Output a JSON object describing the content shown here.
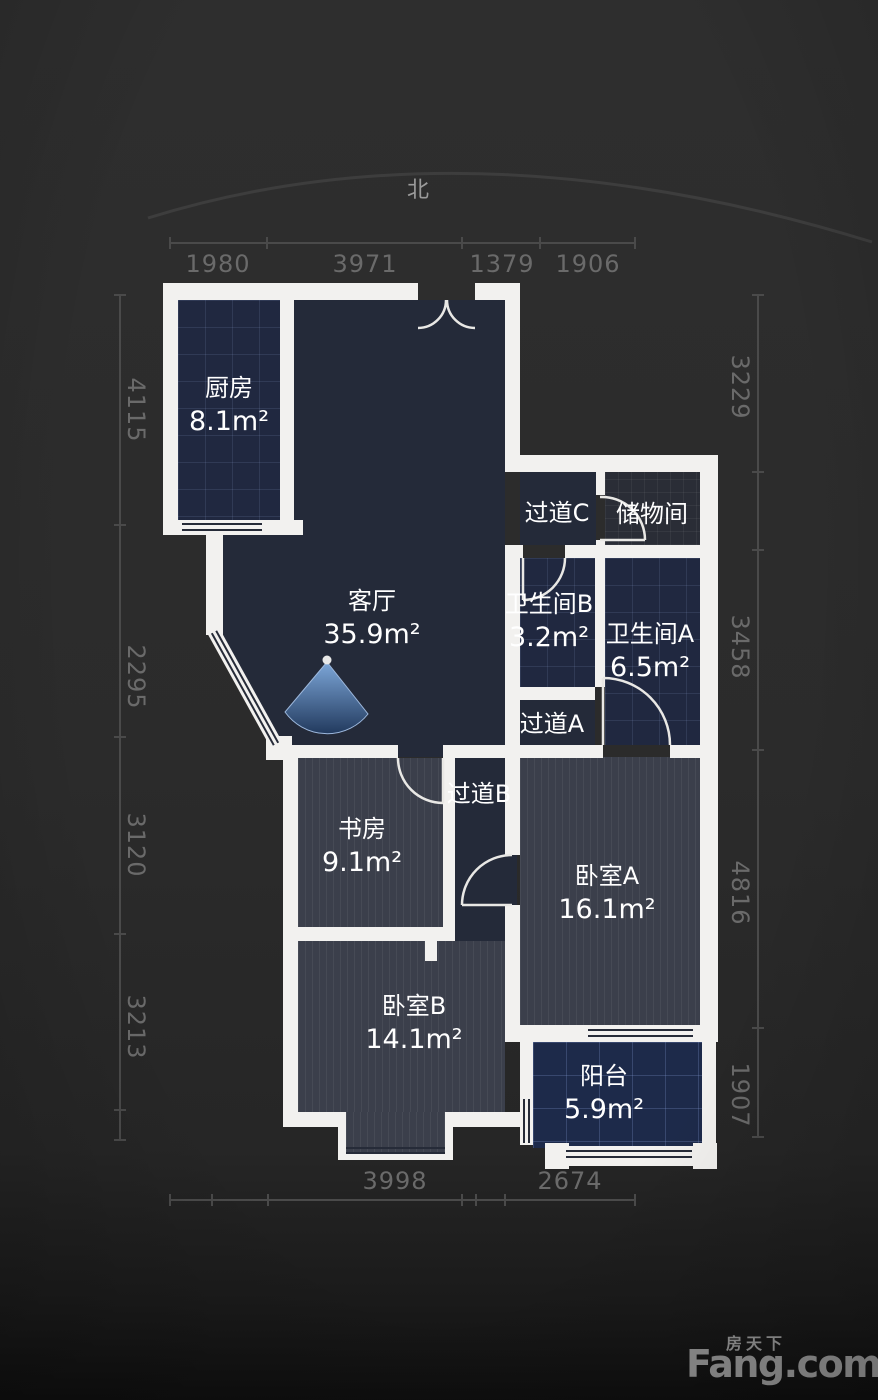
{
  "north_label": "北",
  "rooms": [
    {
      "id": "kitchen",
      "name": "厨房",
      "area": "8.1m²"
    },
    {
      "id": "living",
      "name": "客厅",
      "area": "35.9m²"
    },
    {
      "id": "corridor-c",
      "name": "过道C",
      "area": ""
    },
    {
      "id": "storage",
      "name": "储物间",
      "area": ""
    },
    {
      "id": "bath-b",
      "name": "卫生间B",
      "area": "3.2m²"
    },
    {
      "id": "bath-a",
      "name": "卫生间A",
      "area": "6.5m²"
    },
    {
      "id": "corridor-a",
      "name": "过道A",
      "area": ""
    },
    {
      "id": "study",
      "name": "书房",
      "area": "9.1m²"
    },
    {
      "id": "corridor-b",
      "name": "过道B",
      "area": ""
    },
    {
      "id": "bedroom-a",
      "name": "卧室A",
      "area": "16.1m²"
    },
    {
      "id": "bedroom-b",
      "name": "卧室B",
      "area": "14.1m²"
    },
    {
      "id": "balcony",
      "name": "阳台",
      "area": "5.9m²"
    }
  ],
  "dimensions": {
    "top": [
      "1980",
      "3971",
      "1379",
      "1906"
    ],
    "bottom": [
      "3998",
      "2674"
    ],
    "left": [
      "4115",
      "2295",
      "3120",
      "3213"
    ],
    "right": [
      "3229",
      "3458",
      "4816",
      "1907"
    ]
  },
  "logo": {
    "cn": "房天下",
    "en": "Fang.com"
  },
  "colors": {
    "background": "#2b2b2b",
    "wall": "#f2f1ef",
    "floor_dark": "#242a39",
    "floor_tile": "#202840",
    "floor_balcony": "#1d2a4a",
    "floor_wood": "#3b3f4b",
    "fan_accent": "#5b84c0",
    "dim_text": "#6a6a6a",
    "room_text": "#ffffff",
    "logo_text": "#8d8d8d"
  }
}
